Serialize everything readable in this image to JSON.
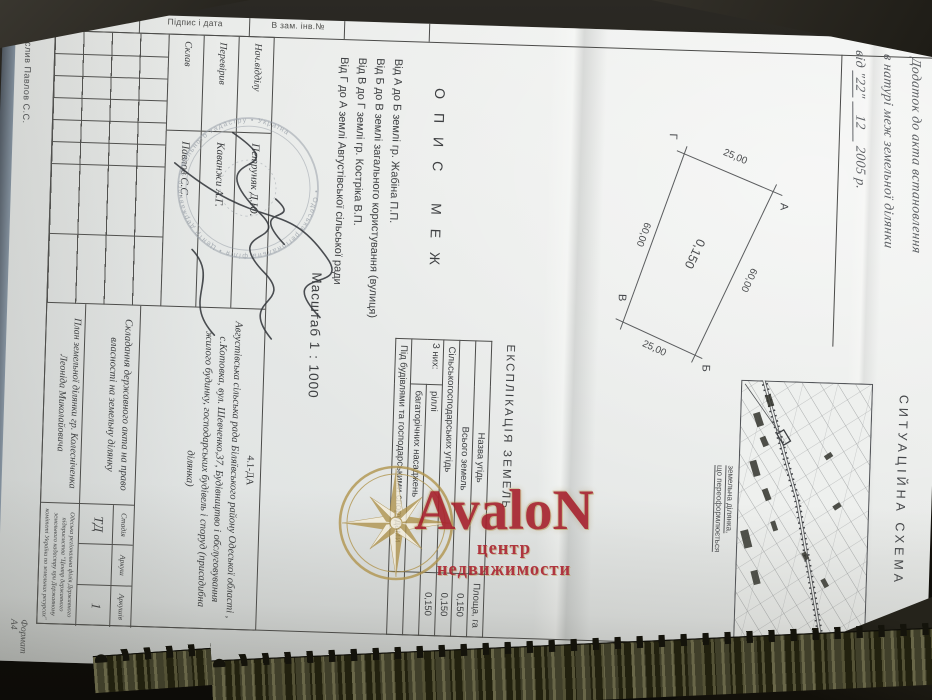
{
  "colors": {
    "paper": "#e8eae8",
    "background": "#17150f",
    "ink": "#3c3e40",
    "watermark_red": "#a6212c",
    "watermark_gold": "#b1954f",
    "seal_ink": "#9aa1a9"
  },
  "annotation": {
    "line1": "Додаток до акта встановлення",
    "line2": "в натурі меж земельної ділянки",
    "line3_prefix": "від",
    "line3_day": "\"22\"",
    "line3_month": "12",
    "line3_year": "2005 р."
  },
  "frame": {
    "margin_cells": [
      "В зам. інв.№",
      "Підпис і дата",
      "Інв. № ориг."
    ],
    "drawn_by": "Креслив Павлов С.С.",
    "format_label": "Формат А4"
  },
  "boundary_description": {
    "title": "ОПИС МЕЖ",
    "lines": [
      "Від А до Б землі гр. Жабіна П.П.",
      "Від Б до В землі загального користування (вулиця)",
      "Від В до Г землі гр. Костріка В.П.",
      "Від Г до А землі Августівської сільської ради"
    ]
  },
  "scale_label": "Масштаб 1 : 1000",
  "parcel_plan": {
    "area_ha": "0,150",
    "corner_a": "А",
    "corner_b": "Б",
    "corner_v": "В",
    "corner_g": "Г",
    "side_ga": "25,00",
    "side_ab": "60,00",
    "side_bv": "25,00",
    "side_vg": "60,00"
  },
  "explication": {
    "title": "ЕКСПЛІКАЦІЯ ЗЕМЕЛЬ",
    "col_name": "Назва угідь",
    "col_area": "Площа, га",
    "group_label": "З них:",
    "rows": [
      {
        "name": "Всього земель",
        "area": "0,150"
      },
      {
        "name": "Сільськогосподарських угідь",
        "area": "0,150"
      },
      {
        "name": "ріллі",
        "area": "0,150"
      },
      {
        "name": "багаторічних насаджень",
        "area": ""
      },
      {
        "name": "Під будівлями та господарськими спорудами",
        "area": ""
      }
    ]
  },
  "situational_schema": {
    "title": "СИТУАЦІЙНА СХЕМА",
    "label_line1": "земельна ділянка,",
    "label_line2": "що переоформлюється"
  },
  "title_block": {
    "code": "4.1-ДА",
    "staff": [
      {
        "role": "Нач.відділу",
        "name": "Петруняк Д.Ю."
      },
      {
        "role": "Перевірив",
        "name": "Каванжи А.Г."
      },
      {
        "role": "Склав",
        "name": "Павлов С.С."
      }
    ],
    "address": "Августівська сільська рада Біляївського району Одеської області , с.Котовка, вул. Шевченко,37, Будівництво і обслуговування жилого будинку, господарських будівель і споруд (присадибна ділянка)",
    "task": "Складання державного акта на право власності на земельну ділянку",
    "doc_title": "План земельної ділянки гр. Колесніченка Леоніда Миколайовича",
    "stage_label": "Стадія",
    "sheet_label": "Аркуш",
    "sheets_label": "Аркушів",
    "stage_value": "ТД",
    "sheet_value": "",
    "sheets_value": "1",
    "org": "Одеська регіональна філія Державного підприємства \"Центр державного земельного кадастру при Державному комітеті України по земельних ресурсах\""
  },
  "seal_text": "• Одеська регіональна філія • Центр державного земельного кадастру • Україна",
  "watermark": {
    "brand": "AvaloN",
    "tagline": "центр недвижимости"
  }
}
